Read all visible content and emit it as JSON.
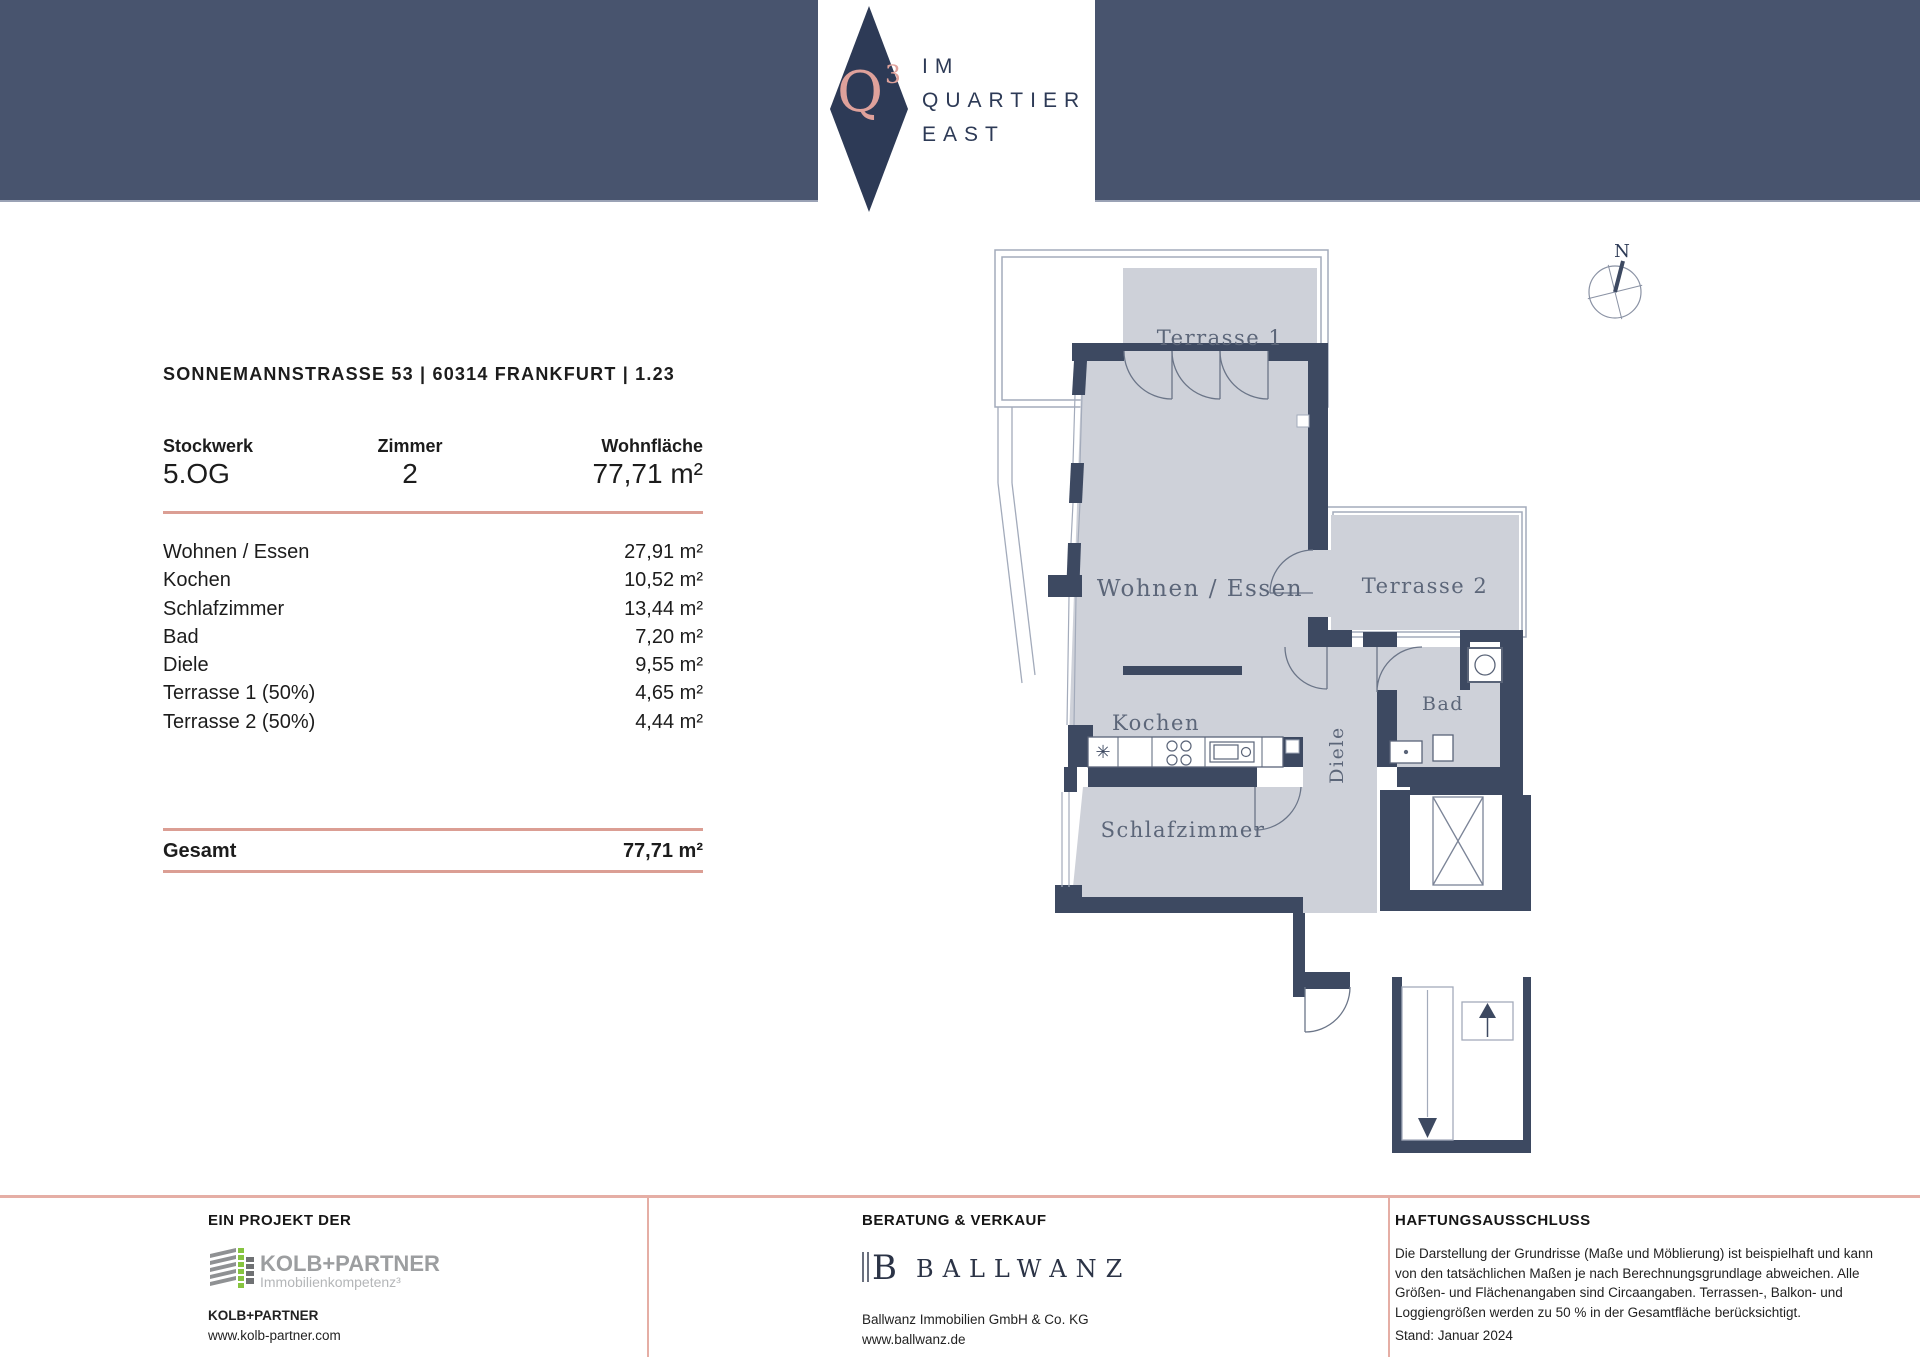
{
  "header": {
    "logo_q": "Q",
    "logo_exp": "3",
    "brand_line1": "IM",
    "brand_line2": "QUARTIER",
    "brand_line3": "EAST",
    "colors": {
      "bar": "#48546e",
      "diamond": "#2d3a56",
      "accent_pink": "#dfa19b",
      "line_salmon": "#db9e94"
    }
  },
  "info": {
    "address_line": "SONNEMANNSTRASSE 53 | 60314 FRANKFURT | 1.23",
    "floor_label": "Stockwerk",
    "floor_value": "5.OG",
    "rooms_label": "Zimmer",
    "rooms_value": "2",
    "area_label": "Wohnfläche",
    "area_value": "77,71 m²",
    "room_list": [
      {
        "name": "Wohnen / Essen",
        "area": "27,91 m²"
      },
      {
        "name": "Kochen",
        "area": "10,52 m²"
      },
      {
        "name": "Schlafzimmer",
        "area": "13,44 m²"
      },
      {
        "name": "Bad",
        "area": "7,20 m²"
      },
      {
        "name": "Diele",
        "area": "9,55 m²"
      },
      {
        "name": "Terrasse 1 (50%)",
        "area": "4,65 m²"
      },
      {
        "name": "Terrasse 2 (50%)",
        "area": "4,44 m²"
      }
    ],
    "total_label": "Gesamt",
    "total_value": "77,71 m²"
  },
  "floorplan": {
    "labels": {
      "terrasse1": "Terrasse 1",
      "wohnen_essen": "Wohnen / Essen",
      "terrasse2": "Terrasse 2",
      "kochen": "Kochen",
      "diele": "Diele",
      "bad": "Bad",
      "schlafzimmer": "Schlafzimmer"
    },
    "north": "N",
    "colors": {
      "wall": "#3d4961",
      "room_fill": "#ced1d9",
      "outline": "#a3abbb",
      "label": "#5c6679"
    }
  },
  "footer": {
    "col1": {
      "heading": "EIN PROJEKT DER",
      "logo_name": "KOLB+PARTNER",
      "logo_sub": "Immobilienkompetenz³",
      "company": "KOLB+PARTNER",
      "website": "www.kolb-partner.com"
    },
    "col2": {
      "heading": "BERATUNG & VERKAUF",
      "logo_b": "B",
      "logo_name": "BALLWANZ",
      "company": "Ballwanz Immobilien GmbH & Co. KG",
      "website": "www.ballwanz.de"
    },
    "col3": {
      "heading": "HAFTUNGSAUSSCHLUSS",
      "text": "Die Darstellung der Grundrisse (Maße und Möblierung) ist beispielhaft und kann von den tatsächlichen Maßen je nach Berechnungsgrundlage abweichen. Alle Größen- und Flächenangaben sind Circaangaben. Terrassen-, Balkon- und Loggiengrößen werden zu 50 % in der Gesamtfläche berücksichtigt.",
      "date": "Stand: Januar 2024"
    }
  }
}
